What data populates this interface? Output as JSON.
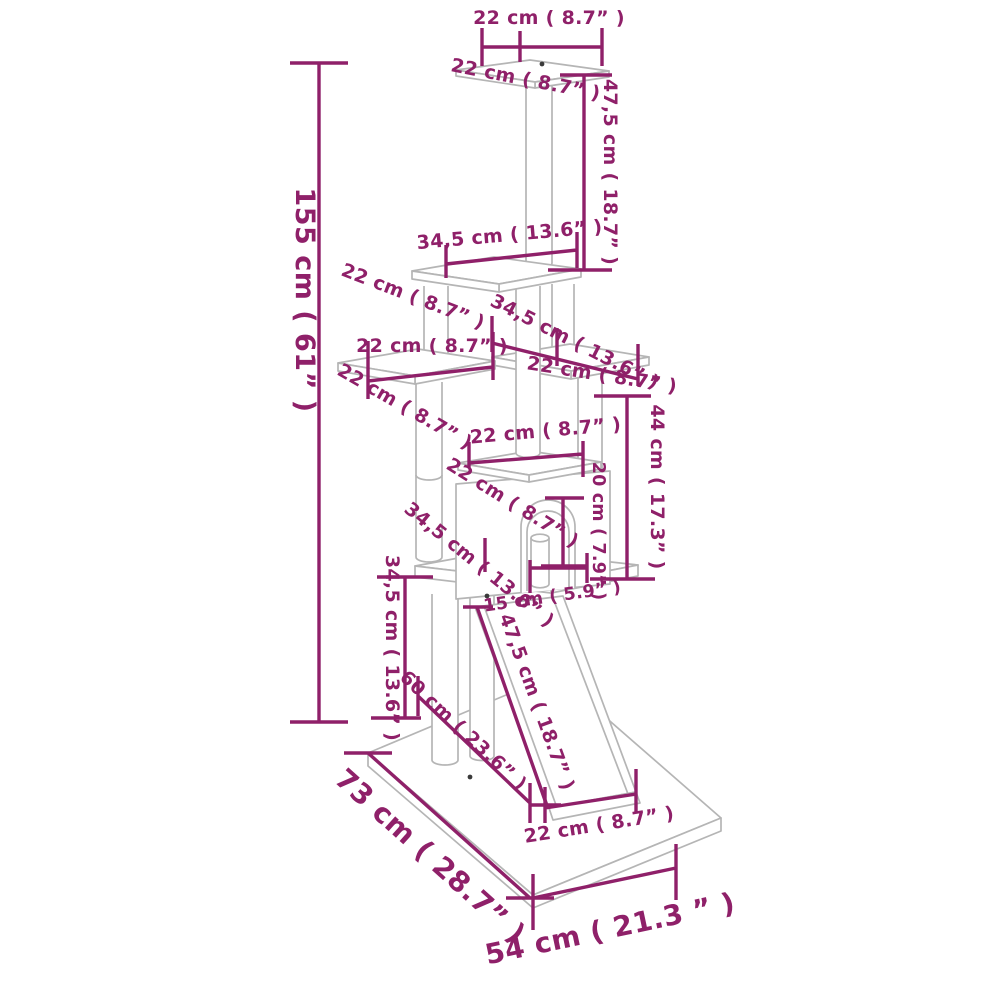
{
  "diagram": {
    "subject": "cat-tree-dimension-diagram",
    "colors": {
      "dimension_accent": "#8f2069",
      "drawing_line": "#b5b5b5",
      "background": "#ffffff"
    },
    "labels": {
      "top_platform_width": "22 cm ( 8.7” )",
      "top_platform_depth": "22 cm ( 8.7” )",
      "upper_post_height": "47,5 cm ( 18.7” )",
      "second_platform_width": "34,5 cm ( 13.6” )",
      "second_platform_depth": "22 cm ( 8.7” )",
      "right_platform_span": "34,5 cm ( 13.6” )",
      "left_platform_width": "22 cm ( 8.7” )",
      "left_platform_depth": "22 cm ( 8.7” )",
      "right_platform_width": "22 cm ( 8.7” )",
      "middle_section_height": "44 cm ( 17.3” )",
      "condo_roof_width": "22 cm ( 8.7” )",
      "condo_roof_depth": "22 cm ( 8.7” )",
      "condo_door_height": "20 cm ( 7.9” )",
      "lower_platform_span": "34,5 cm ( 13.6” )",
      "condo_door_width": "15 cm ( 5.9” )",
      "lower_section_height": "34,5 cm ( 13.6” )",
      "base_diagonal": "60 cm ( 23.6” )",
      "ramp_length": "47,5 cm ( 18.7” )",
      "ramp_width": "22 cm ( 8.7” )",
      "total_height": "155 cm ( 61” )",
      "base_depth": "73 cm ( 28.7” )",
      "base_width": "54 cm  ( 21.3 ” )"
    }
  }
}
